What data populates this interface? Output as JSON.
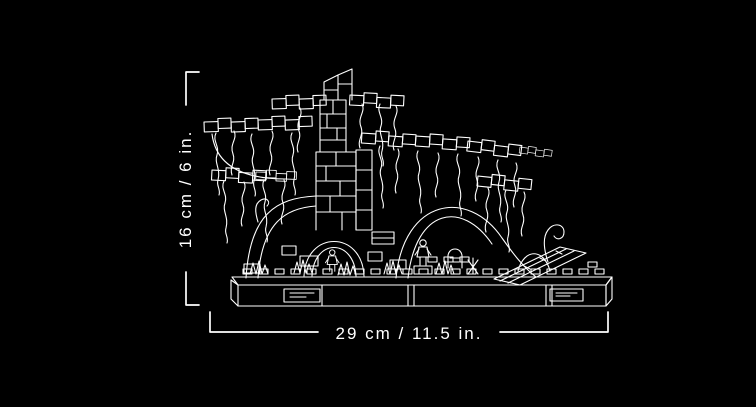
{
  "scene": {
    "background_color": "#000000",
    "line_color": "#ffffff",
    "illustration": "lego-diorama-line-art"
  },
  "measurements": {
    "height_label": "16 cm / 6 in.",
    "width_label": "29 cm / 11.5 in."
  }
}
